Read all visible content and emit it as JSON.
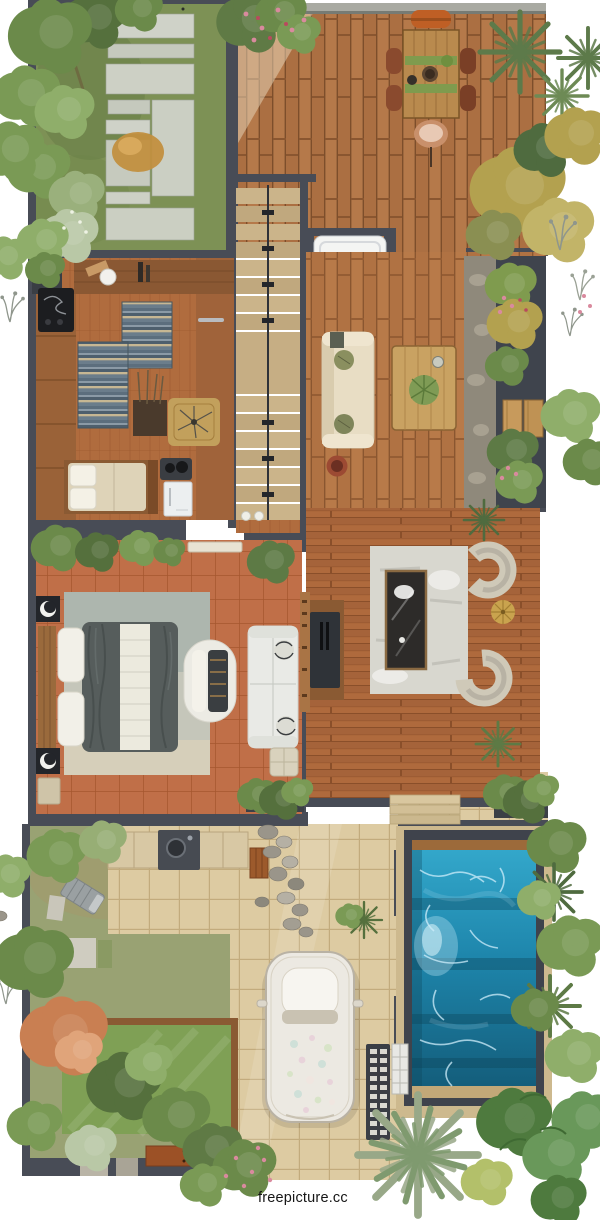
{
  "watermark": {
    "text": "freepicture.cc"
  },
  "scene": {
    "type": "floor-plan-render",
    "view": "top-down",
    "areas": [
      "front-garden",
      "dining-deck",
      "staircase",
      "bathtub",
      "kitchen-studio",
      "living-room",
      "side-planter",
      "master-bedroom",
      "family-room",
      "outdoor-kitchen",
      "backyard-garden",
      "lawn",
      "driveway",
      "parked-car",
      "swimming-pool",
      "tropical-plants"
    ]
  },
  "palette": {
    "wall": "#484c56",
    "deck_wood": "#b5794a",
    "floor_wood": "#b06c3e",
    "terracotta": "#c06f48",
    "patio_tile": "#ddcba2",
    "grass": "#7d9155",
    "lawn": "#7fa055",
    "rug_blue": "#5c6e7d",
    "rug_gray": "#c5c6ba",
    "sofa_cream": "#e8ddc4",
    "duvet_gray": "#565d5c",
    "pool_light": "#35aacd",
    "pool_dark": "#135a77",
    "stone_deck": "#cdb98e",
    "counter_beige": "#d8c8a4",
    "appliance_white": "#eceff0",
    "plant_dark": "#55703d",
    "plant_mid": "#6b8a4a",
    "plant_light": "#8fae6a",
    "plant_yellow": "#b3a14f",
    "autumn_tree": "#c97f52",
    "flower_pink": "#d98a9e",
    "table_wood": "#c9a262",
    "charcoal": "#2f3338",
    "watermark_text": "#161616"
  }
}
